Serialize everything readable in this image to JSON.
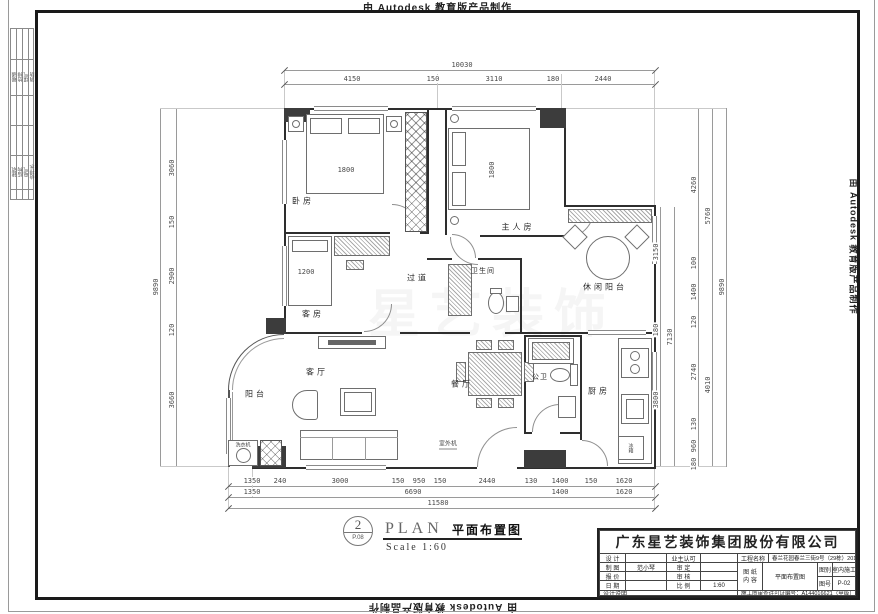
{
  "autodesk": {
    "credit": "由 Autodesk 教育版产品制作"
  },
  "watermark": {
    "text": "星艺装饰"
  },
  "plan_bubble": {
    "number": "2",
    "sheet": "P.08",
    "name_en": "PLAN",
    "name_cn": "平面布置图",
    "scale": "Scale 1:60"
  },
  "signoff": {
    "g1": [
      "暖通",
      "给排",
      "煤气",
      "消防"
    ],
    "g2": [
      "建筑",
      "结构",
      "电气",
      "给排水"
    ]
  },
  "rooms": {
    "bedroom": "卧房",
    "master": "主人房",
    "leisure_balcony": "休闲阳台",
    "corridor": "过道",
    "bathroom": "卫生间",
    "guest": "客房",
    "living": "客厅",
    "balcony": "阳台",
    "dining": "餐厅",
    "public_wc": "公卫",
    "kitchen": "厨房",
    "washer": "洗衣机",
    "ac_unit": "室外机",
    "fridge": "冰箱"
  },
  "inline_dims": {
    "bed1": "1800",
    "master_bed": "1800",
    "guest_bed": "1200"
  },
  "dims": {
    "top": {
      "total": "10030",
      "segments": [
        "4150",
        "150",
        "3110",
        "180",
        "2440"
      ]
    },
    "left": {
      "total": "9890",
      "segments": [
        "3060",
        "150",
        "2900",
        "120",
        "3660"
      ]
    },
    "right": {
      "chain1": [
        "3150",
        "180",
        "3800"
      ],
      "chain1_total": "7130",
      "chain2": [
        "4260",
        "100",
        "1400",
        "120",
        "2740",
        "130",
        "960",
        "180"
      ],
      "chain3": [
        "5760",
        "4010"
      ],
      "total": "9890"
    },
    "bottom": {
      "row1": [
        "1350",
        "240",
        "3000",
        "150",
        "950",
        "150",
        "2440",
        "130",
        "1400",
        "150",
        "1620"
      ],
      "row2": [
        "1350",
        "6690",
        "1400",
        "1620"
      ],
      "total": "11580"
    }
  },
  "tb": {
    "company": "广东星艺装饰集团股份有限公司",
    "rows": [
      {
        "l": "设 计",
        "v": "",
        "l2": "业主认可",
        "v2": ""
      },
      {
        "l": "制 图",
        "v": "范小琴",
        "l2": "审 定",
        "v2": ""
      },
      {
        "l": "报 价",
        "v": "",
        "l2": "审 核",
        "v2": ""
      },
      {
        "l": "日 期",
        "v": "",
        "l2": "比 例",
        "v2": "1:60"
      }
    ],
    "project_l": "工程名称",
    "project_v": "春兰花园春兰三街9号（29栋）201房",
    "sheet_l1": "图 纸",
    "sheet_l2": "内 容",
    "sheet_v": "平面布置图",
    "type_l": "图别",
    "type_v": "室内施工",
    "num_l": "图号",
    "num_v": "P-02",
    "note": "设计说明",
    "permit": "施工图审查许可证编号：A144016621（甲级）"
  }
}
